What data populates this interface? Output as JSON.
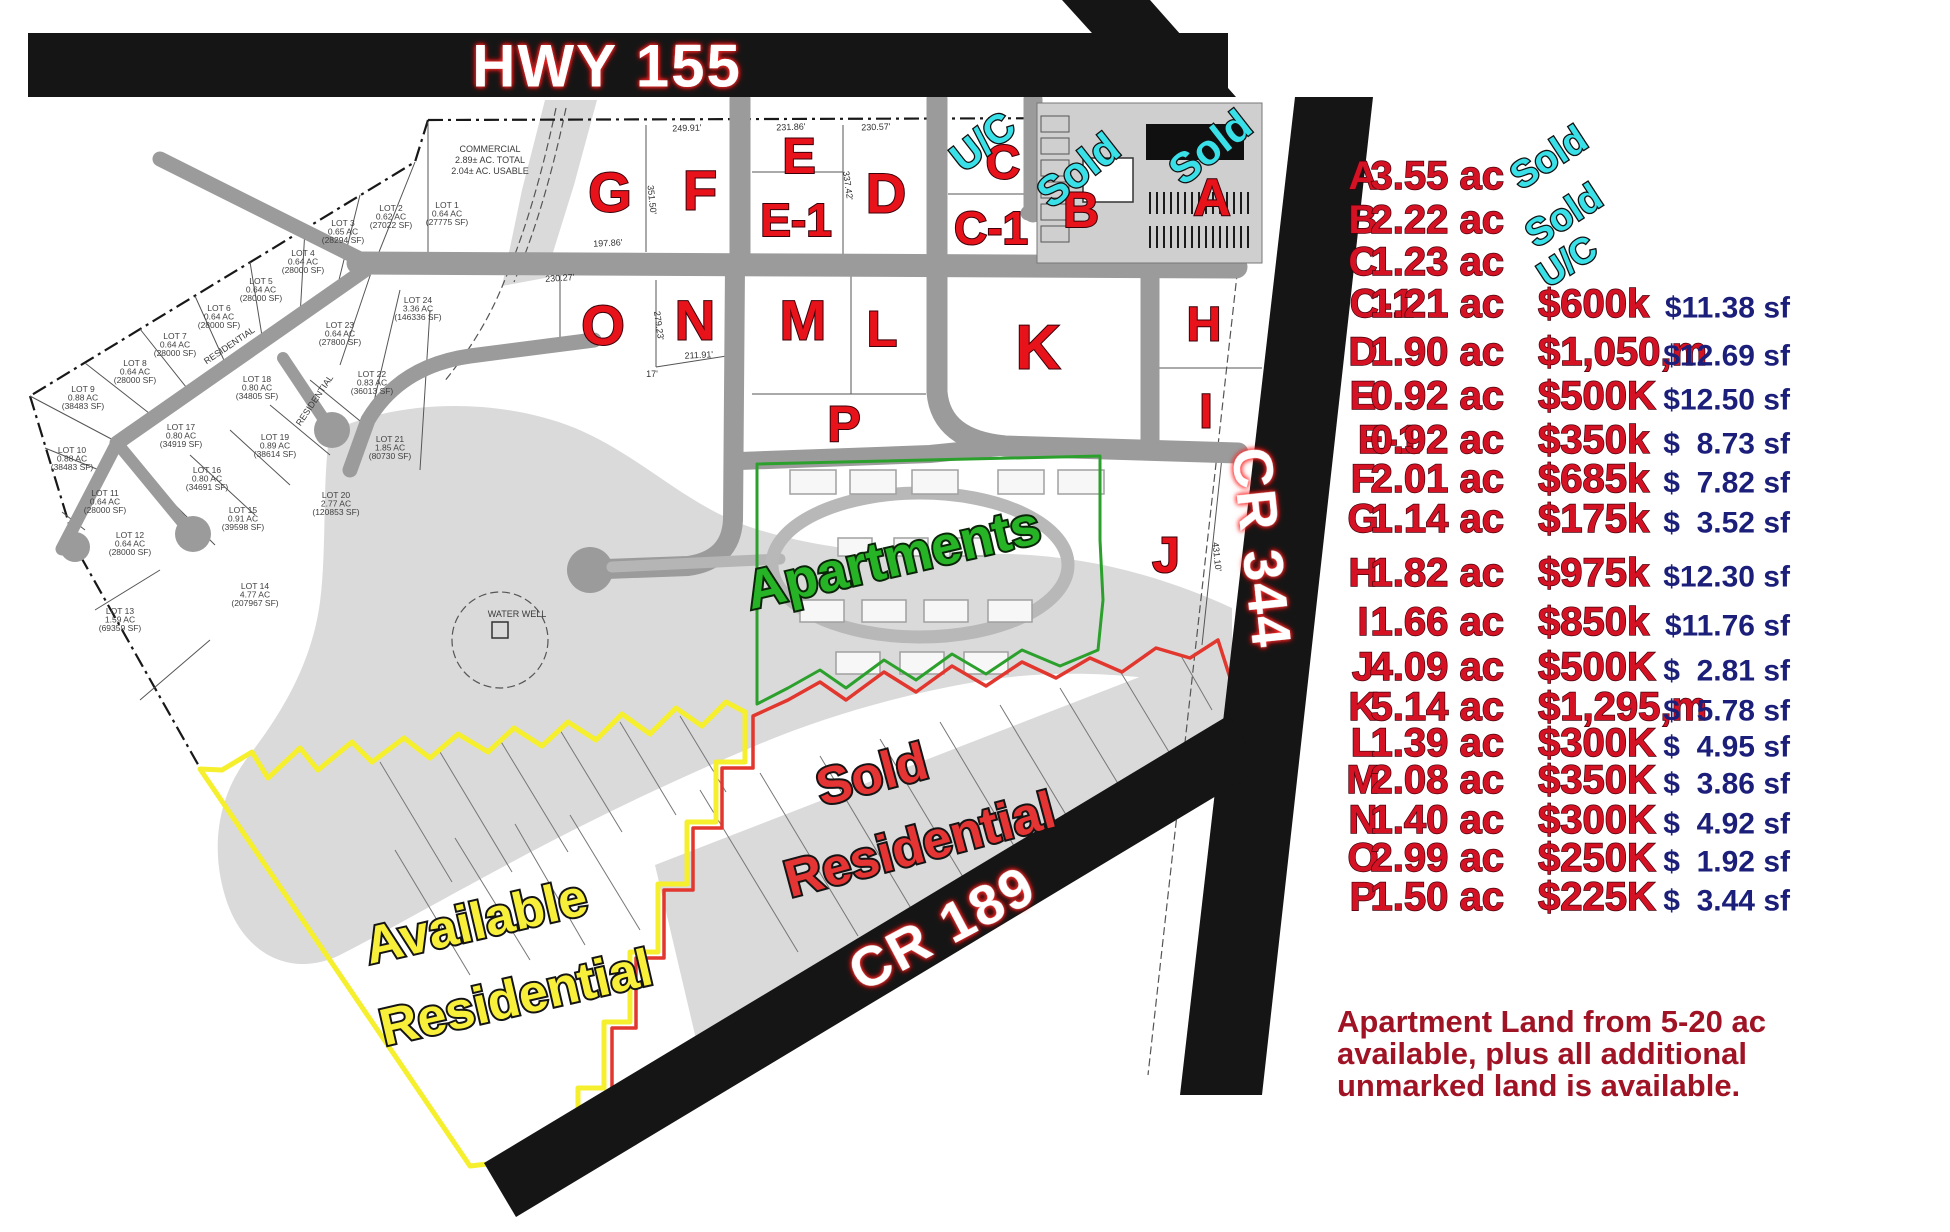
{
  "colors": {
    "parcel_red": "#e8121a",
    "cyan": "#3ae0e8",
    "apartments_green": "#26b426",
    "available_yellow": "#f8ef3a",
    "sold_red": "#e43434",
    "table_red": "#d41224",
    "psf_navy": "#1b1f7a",
    "note_red": "#a01325",
    "road_black": "#151515"
  },
  "roads": {
    "hwy155": "HWY 155",
    "cr344": "CR 344",
    "cr189": "CR 189"
  },
  "map": {
    "region_labels": {
      "apartments": "Apartments",
      "available_line1": "Available",
      "available_line2": "Residential",
      "sold_line1": "Sold",
      "sold_line2": "Residential"
    },
    "parcels": [
      {
        "id": "G",
        "x": 610,
        "y": 192,
        "s": 56
      },
      {
        "id": "F",
        "x": 700,
        "y": 190,
        "s": 56
      },
      {
        "id": "E",
        "x": 799,
        "y": 156,
        "s": 50
      },
      {
        "id": "E-1",
        "x": 796,
        "y": 220,
        "s": 46
      },
      {
        "id": "D",
        "x": 886,
        "y": 193,
        "s": 56
      },
      {
        "id": "C",
        "x": 1003,
        "y": 163,
        "s": 48
      },
      {
        "id": "C-1",
        "x": 991,
        "y": 228,
        "s": 46
      },
      {
        "id": "B",
        "x": 1081,
        "y": 210,
        "s": 50
      },
      {
        "id": "A",
        "x": 1212,
        "y": 198,
        "s": 52
      },
      {
        "id": "O",
        "x": 603,
        "y": 325,
        "s": 56
      },
      {
        "id": "N",
        "x": 695,
        "y": 320,
        "s": 56
      },
      {
        "id": "M",
        "x": 803,
        "y": 320,
        "s": 56
      },
      {
        "id": "L",
        "x": 882,
        "y": 329,
        "s": 50
      },
      {
        "id": "K",
        "x": 1038,
        "y": 348,
        "s": 62
      },
      {
        "id": "P",
        "x": 844,
        "y": 424,
        "s": 50
      },
      {
        "id": "H",
        "x": 1204,
        "y": 325,
        "s": 48
      },
      {
        "id": "I",
        "x": 1206,
        "y": 412,
        "s": 48
      },
      {
        "id": "J",
        "x": 1166,
        "y": 555,
        "s": 50
      }
    ],
    "status_labels": [
      {
        "t": "U/C",
        "x": 983,
        "y": 142,
        "r": -38,
        "s": 40
      },
      {
        "t": "Sold",
        "x": 1078,
        "y": 170,
        "r": -38,
        "s": 42
      },
      {
        "t": "Sold",
        "x": 1210,
        "y": 147,
        "r": -38,
        "s": 42
      }
    ],
    "lots": [
      {
        "n": "LOT 1",
        "a": "0.64 AC",
        "s": "(27775 SF)",
        "x": 447,
        "y": 208
      },
      {
        "n": "LOT 2",
        "a": "0.62 AC",
        "s": "(27022 SF)",
        "x": 391,
        "y": 211
      },
      {
        "n": "LOT 3",
        "a": "0.65 AC",
        "s": "(28294 SF)",
        "x": 343,
        "y": 226
      },
      {
        "n": "LOT 4",
        "a": "0.64 AC",
        "s": "(28000 SF)",
        "x": 303,
        "y": 256
      },
      {
        "n": "LOT 5",
        "a": "0.64 AC",
        "s": "(28000 SF)",
        "x": 261,
        "y": 284
      },
      {
        "n": "LOT 6",
        "a": "0.64 AC",
        "s": "(28000 SF)",
        "x": 219,
        "y": 311
      },
      {
        "n": "LOT 7",
        "a": "0.64 AC",
        "s": "(28000 SF)",
        "x": 175,
        "y": 339
      },
      {
        "n": "LOT 8",
        "a": "0.64 AC",
        "s": "(28000 SF)",
        "x": 135,
        "y": 366
      },
      {
        "n": "LOT 9",
        "a": "0.88 AC",
        "s": "(38483 SF)",
        "x": 83,
        "y": 392
      },
      {
        "n": "LOT 10",
        "a": "0.88 AC",
        "s": "(38483 SF)",
        "x": 72,
        "y": 453
      },
      {
        "n": "LOT 11",
        "a": "0.64 AC",
        "s": "(28000 SF)",
        "x": 105,
        "y": 496
      },
      {
        "n": "LOT 12",
        "a": "0.64 AC",
        "s": "(28000 SF)",
        "x": 130,
        "y": 538
      },
      {
        "n": "LOT 13",
        "a": "1.59 AC",
        "s": "(69359 SF)",
        "x": 120,
        "y": 614
      },
      {
        "n": "LOT 14",
        "a": "4.77 AC",
        "s": "(207967 SF)",
        "x": 255,
        "y": 589
      },
      {
        "n": "LOT 15",
        "a": "0.91 AC",
        "s": "(39598 SF)",
        "x": 243,
        "y": 513
      },
      {
        "n": "LOT 16",
        "a": "0.80 AC",
        "s": "(34691 SF)",
        "x": 207,
        "y": 473
      },
      {
        "n": "LOT 17",
        "a": "0.80 AC",
        "s": "(34919 SF)",
        "x": 181,
        "y": 430
      },
      {
        "n": "LOT 18",
        "a": "0.80 AC",
        "s": "(34805 SF)",
        "x": 257,
        "y": 382
      },
      {
        "n": "LOT 19",
        "a": "0.89 AC",
        "s": "(38614 SF)",
        "x": 275,
        "y": 440
      },
      {
        "n": "LOT 20",
        "a": "2.77 AC",
        "s": "(120853 SF)",
        "x": 336,
        "y": 498
      },
      {
        "n": "LOT 21",
        "a": "1.85 AC",
        "s": "(80730 SF)",
        "x": 390,
        "y": 442
      },
      {
        "n": "LOT 22",
        "a": "0.83 AC",
        "s": "(36013 SF)",
        "x": 372,
        "y": 377
      },
      {
        "n": "LOT 23",
        "a": "0.64 AC",
        "s": "(27800 SF)",
        "x": 340,
        "y": 328
      },
      {
        "n": "LOT 24",
        "a": "3.36 AC",
        "s": "(146336 SF)",
        "x": 418,
        "y": 303
      }
    ],
    "dims": [
      {
        "t": "249.91'",
        "x": 687,
        "y": 131,
        "r": -2
      },
      {
        "t": "231.86'",
        "x": 791,
        "y": 130,
        "r": -2
      },
      {
        "t": "230.57'",
        "x": 876,
        "y": 130,
        "r": -2
      },
      {
        "t": "197.86'",
        "x": 608,
        "y": 246,
        "r": -3
      },
      {
        "t": "230.27'",
        "x": 560,
        "y": 281,
        "r": -4
      },
      {
        "t": "211.91'",
        "x": 699,
        "y": 358,
        "r": -3
      },
      {
        "t": "351.50'",
        "x": 649,
        "y": 200,
        "r": 84
      },
      {
        "t": "337.42'",
        "x": 845,
        "y": 186,
        "r": 82
      },
      {
        "t": "279.23'",
        "x": 656,
        "y": 326,
        "r": 82
      },
      {
        "t": "431.10'",
        "x": 1214,
        "y": 557,
        "r": 84
      },
      {
        "t": "17'",
        "x": 652,
        "y": 377,
        "r": 0
      }
    ],
    "small_labels": [
      {
        "t": "COMMERCIAL",
        "x": 490,
        "y": 152,
        "r": 0
      },
      {
        "t": "2.89± AC. TOTAL",
        "x": 490,
        "y": 163,
        "r": 0
      },
      {
        "t": "2.04± AC. USABLE",
        "x": 490,
        "y": 174,
        "r": 0
      },
      {
        "t": "WATER WELL",
        "x": 517,
        "y": 617,
        "r": 0
      },
      {
        "t": "RESIDENTIAL",
        "x": 231,
        "y": 348,
        "r": -34
      },
      {
        "t": "RESIDENTIAL",
        "x": 317,
        "y": 402,
        "r": -56
      }
    ]
  },
  "table": {
    "rows": [
      {
        "id": "A",
        "y": 176,
        "area": "3.55 ac",
        "price": "",
        "psf": ""
      },
      {
        "id": "B",
        "y": 220,
        "area": "2.22 ac",
        "price": "",
        "psf": ""
      },
      {
        "id": "C",
        "y": 262,
        "area": "1.23 ac",
        "price": "",
        "psf": ""
      },
      {
        "id": "C-1",
        "y": 304,
        "cx": 1382,
        "area": "1.21 ac",
        "price": "$600k",
        "psf": "$11.38 sf"
      },
      {
        "id": "D",
        "y": 352,
        "area": "1.90 ac",
        "price": "$1,050,m",
        "psf": "$12.69 sf"
      },
      {
        "id": "E",
        "y": 396,
        "area": "0.92 ac",
        "price": "$500K",
        "psf": "$12.50 sf"
      },
      {
        "id": "E-1",
        "y": 440,
        "cx": 1389,
        "area": "0.92 ac",
        "price": "$350k",
        "psf": "$  8.73 sf"
      },
      {
        "id": "F",
        "y": 479,
        "area": "2.01 ac",
        "price": "$685k",
        "psf": "$  7.82 sf"
      },
      {
        "id": "G",
        "y": 519,
        "area": "1.14 ac",
        "price": "$175k",
        "psf": "$  3.52 sf"
      },
      {
        "id": "H",
        "y": 573,
        "area": "1.82 ac",
        "price": "$975k",
        "psf": "$12.30 sf"
      },
      {
        "id": "I",
        "y": 622,
        "area": "1.66 ac",
        "price": "$850k",
        "psf": "$11.76 sf"
      },
      {
        "id": "J",
        "y": 667,
        "area": "4.09 ac",
        "price": "$500K",
        "psf": "$  2.81 sf"
      },
      {
        "id": "K",
        "y": 707,
        "area": "5.14 ac",
        "price": "$1,295,m",
        "psf": "$  5.78 sf"
      },
      {
        "id": "L",
        "y": 743,
        "area": "1.39 ac",
        "price": "$300K",
        "psf": "$  4.95 sf"
      },
      {
        "id": "M",
        "y": 780,
        "area": "2.08 ac",
        "price": "$350K",
        "psf": "$  3.86 sf"
      },
      {
        "id": "N",
        "y": 820,
        "area": "1.40 ac",
        "price": "$300K",
        "psf": "$  4.92 sf"
      },
      {
        "id": "O",
        "y": 858,
        "area": "2.99 ac",
        "price": "$250K",
        "psf": "$  1.92 sf"
      },
      {
        "id": "P",
        "y": 897,
        "area": "1.50 ac",
        "price": "$225K",
        "psf": "$  3.44 sf"
      }
    ],
    "status_labels": [
      {
        "t": "Sold",
        "x": 1549,
        "y": 158,
        "r": -33,
        "s": 38
      },
      {
        "t": "Sold",
        "x": 1564,
        "y": 216,
        "r": -33,
        "s": 38
      },
      {
        "t": "U/C",
        "x": 1567,
        "y": 261,
        "r": -33,
        "s": 36
      }
    ]
  },
  "note": {
    "line1": "Apartment Land from 5-20 ac",
    "line2": "available, plus all additional",
    "line3": "unmarked land is available."
  }
}
